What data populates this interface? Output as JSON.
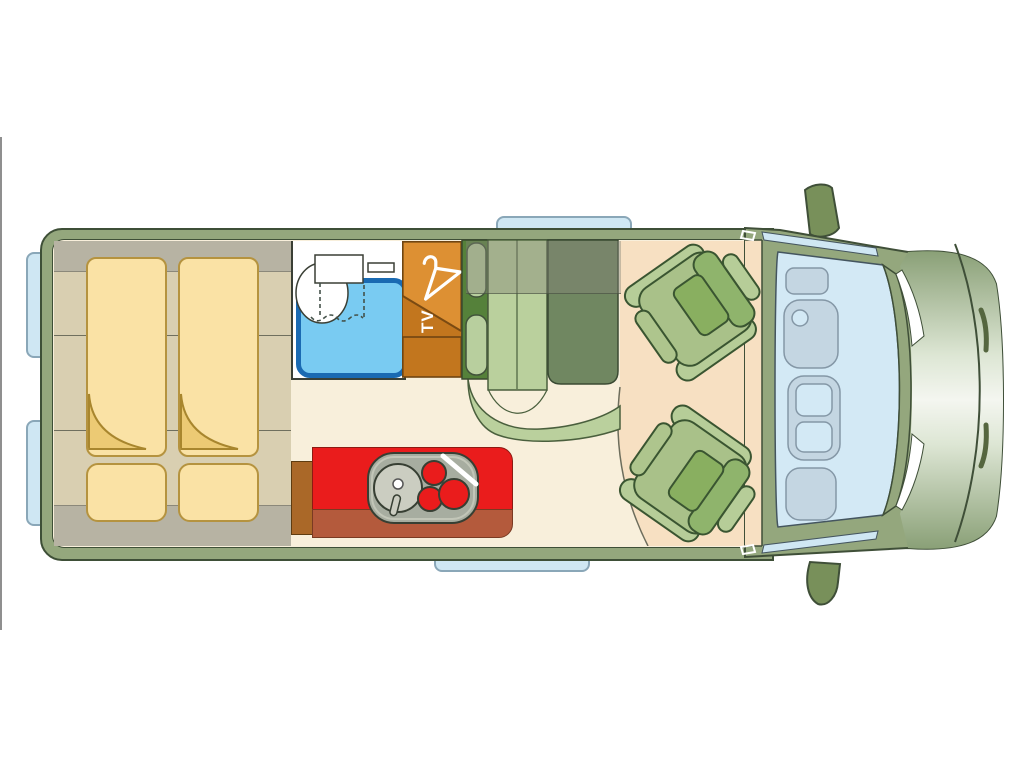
{
  "van_floorplan": {
    "labels": {
      "tv": "TV"
    },
    "zones": [
      {
        "name": "twin-rear-beds"
      },
      {
        "name": "under-bed-storage-bands"
      },
      {
        "name": "bathroom-with-toilet-and-shower"
      },
      {
        "name": "wardrobe-with-tv"
      },
      {
        "name": "kitchen-sink-and-hob"
      },
      {
        "name": "dinette-bench"
      },
      {
        "name": "dinette-table"
      },
      {
        "name": "swivel-seat-front-top"
      },
      {
        "name": "swivel-seat-front-bottom"
      },
      {
        "name": "driver-cab-windshield"
      },
      {
        "name": "hood-and-bumper"
      }
    ],
    "colors": {
      "body_olive": "#94a77d",
      "outline_dark": "#3e4f37",
      "floor_cream": "#f8efdb",
      "floor_peach": "#f7e0c2",
      "bed_platform_khaki": "#d9cfb1",
      "overhead_grey": "#b7b3a3",
      "mattress_yellow": "#fae2a5",
      "mattress_edge": "#b5933f",
      "mattress_fold": "#ecca74",
      "shower_fill": "#79cbf2",
      "shower_frame": "#1a6ab2",
      "wardrobe_light_orange": "#dd9033",
      "wardrobe_dark_orange": "#c2761e",
      "kitchen_red": "#ea1c1c",
      "kitchen_front_band": "#b45a3c",
      "counter_brown": "#aa6828",
      "hob_grey": "#a7ada0",
      "bench_backrest_green": "#55813a",
      "bench_cushion_green": "#bad09d",
      "table_green": "#708761",
      "seat_base_green": "#a9c189",
      "seat_back_green": "#8fb46c",
      "window_glass": "#cfe7f3",
      "windshield_blue": "#d3e9f5",
      "dashboard_blue": "#c4d6e2",
      "mirror_olive": "#78905a"
    }
  }
}
